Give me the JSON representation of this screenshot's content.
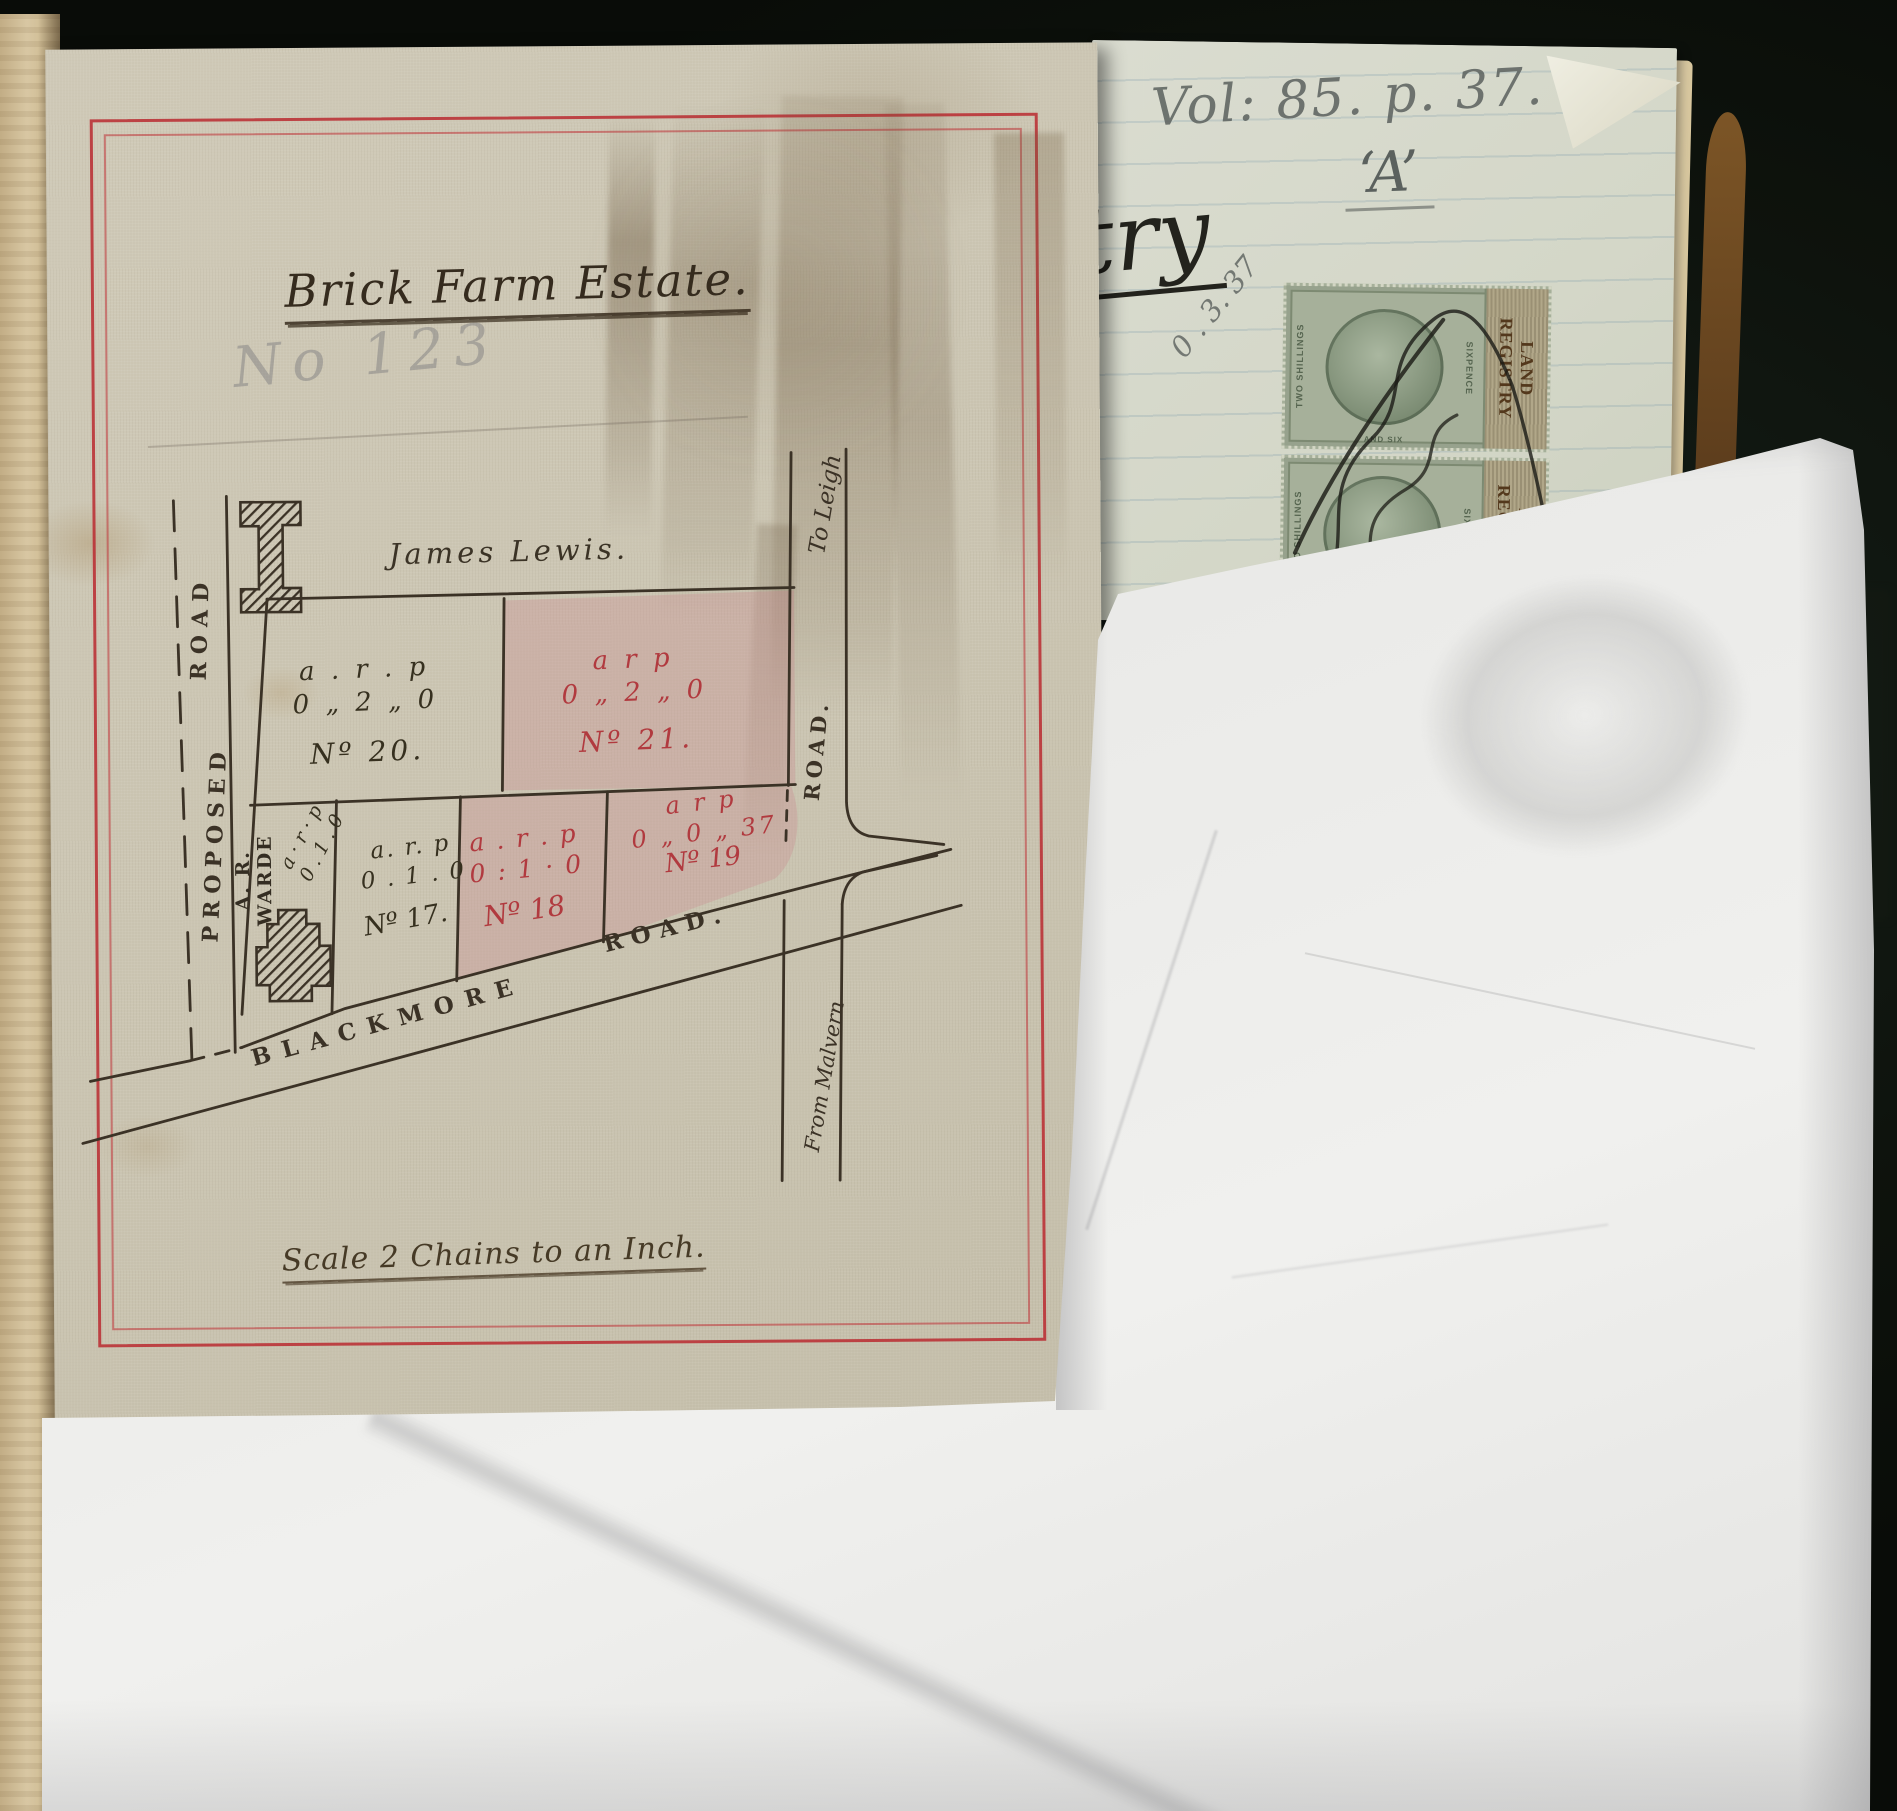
{
  "page": {
    "map_sheet": {
      "title": "Brick Farm Estate.",
      "pencil_annotation": "No 123",
      "owner_name": "James Lewis.",
      "scale_caption": "Scale 2 Chains to an Inch.",
      "road_labels": {
        "proposed_road_word1": "PROPOSED",
        "proposed_road_word2": "ROAD",
        "blackmore_word1": "BLACKMORE",
        "blackmore_word2": "ROAD.",
        "side_road": "ROAD.",
        "destination_top": "To Leigh",
        "destination_bottom": "From Malvern"
      },
      "plots": {
        "no20": {
          "arp": "a . r . p",
          "area": "0 „ 2 „ 0",
          "number": "Nº 20."
        },
        "no21": {
          "arp": "a   r   p",
          "area": "0 „ 2 „ 0",
          "number": "Nº 21."
        },
        "warde": {
          "owner": "A. R. WARDE",
          "arp": "a · r · p",
          "area": "0 . 1 . 0"
        },
        "no17": {
          "arp": "a. r. p",
          "area": "0 . 1 . 0",
          "number": "Nº 17."
        },
        "no18": {
          "arp": "a . r . p",
          "area": "0 : 1 · 0",
          "number": "Nº 18"
        },
        "no19": {
          "arp": "a   r   p",
          "area": "0 „ 0 „ 37",
          "number": "Nº 19"
        }
      }
    },
    "ledger_page": {
      "volume_reference": "Vol: 85. p. 37.",
      "section_letter": "‘A’",
      "script_fragment": "try",
      "pencil_numbers": "0 . 3. 37",
      "stamps": {
        "denomination_left": "TWO SHILLINGS",
        "denomination_right": "SIXPENCE",
        "denomination_bottom": "AND SIX",
        "panel_word1": "LAND",
        "panel_word2": "REGISTRY"
      }
    },
    "colors": {
      "border_red": "#b92a30",
      "plot_pink": "#c98a90",
      "red_ink": "#b13a3f",
      "black_ink": "#36301f",
      "pencil": "#5b615e",
      "stamp_green": "#a6b09a",
      "stamp_panel_brown": "#53381c",
      "linen_paper": "#cbc5b2",
      "background": "#10140e"
    }
  }
}
